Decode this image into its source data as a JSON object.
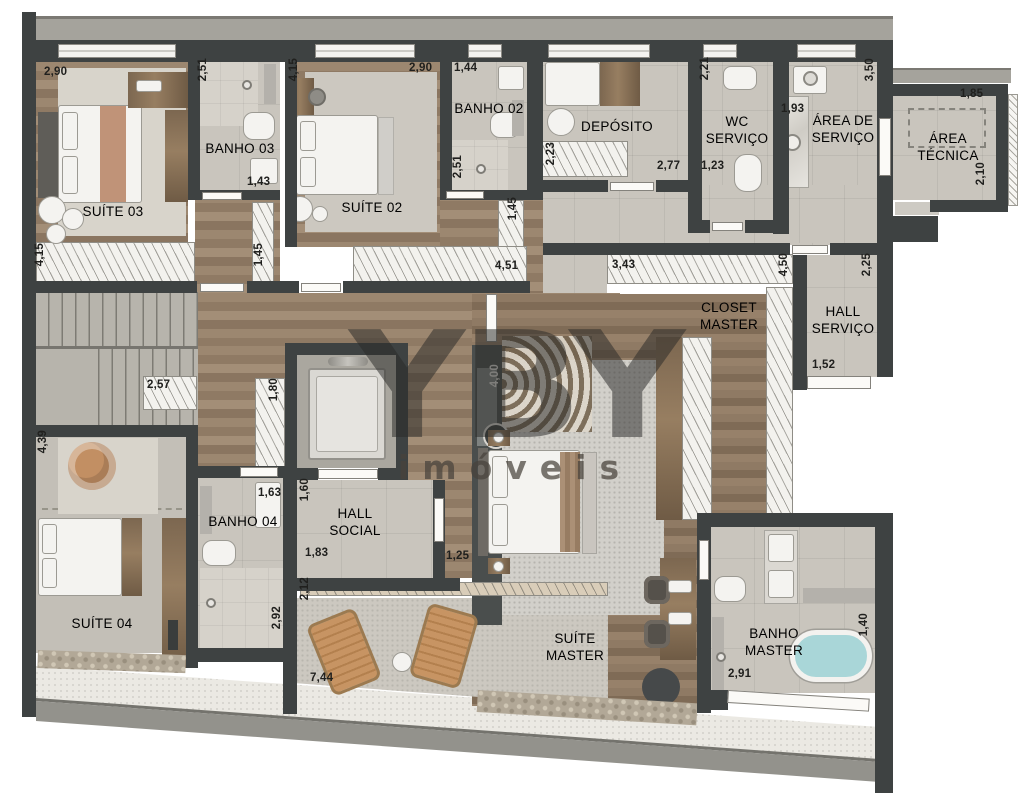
{
  "watermark": {
    "logo": "YBY",
    "tagline": "imóveis"
  },
  "rooms": {
    "suite03": "SUÍTE 03",
    "banho03": "BANHO 03",
    "suite02": "SUÍTE 02",
    "banho02": "BANHO 02",
    "deposito": "DEPÓSITO",
    "wc_servico": "WC SERVIÇO",
    "area_servico": "ÁREA DE SERVIÇO",
    "area_tecnica": "ÁREA TÉCNICA",
    "hall_servico": "HALL SERVIÇO",
    "closet_master": "CLOSET MASTER",
    "hall_social": "HALL SOCIAL",
    "banho04": "BANHO 04",
    "suite04": "SUÍTE 04",
    "suite_master": "SUÍTE MASTER",
    "banho_master": "BANHO MASTER"
  },
  "dimensions": {
    "suite03_width": "2,90",
    "banho03_depth": "2,51",
    "suite02_depth": "4,15",
    "suite02_width": "2,90",
    "banho02_width": "1,44",
    "wc_depth": "2,21",
    "area_servico_width": "1,93",
    "area_servico_depth": "3,50",
    "area_tecnica_width": "1,85",
    "area_tecnica_depth": "2,10",
    "deposito_shelf": "2,23",
    "deposito_width": "2,77",
    "wc_width": "1,23",
    "banho02_shower": "2,51",
    "banho03_width": "1,43",
    "wardrobe_left": "1,45",
    "wardrobe_right": "1,45",
    "wardrobe_long": "4,51",
    "closet_top": "3,43",
    "closet_side": "4,50",
    "hall_servico_depth": "2,25",
    "hall_servico_width": "1,52",
    "corridor_wardrobe": "4,15",
    "stair_closet": "2,57",
    "shoe_cabinet": "1,80",
    "suite04_depth": "4,39",
    "banho04_width": "1,63",
    "hall_social_depth": "1,60",
    "hall_social_width": "1,83",
    "passage": "1,25",
    "terrace_depth": "2,12",
    "banho04_depth": "2,92",
    "terrace_width": "7,44",
    "media_wall": "4,00",
    "banho_master_width": "2,91",
    "banho_master_depth": "1,40"
  },
  "colors": {
    "wall": "#3e4242",
    "wood_floor": "#96816b",
    "tile_floor": "#c9c5bd",
    "bath_water": "#a9d6d8"
  }
}
